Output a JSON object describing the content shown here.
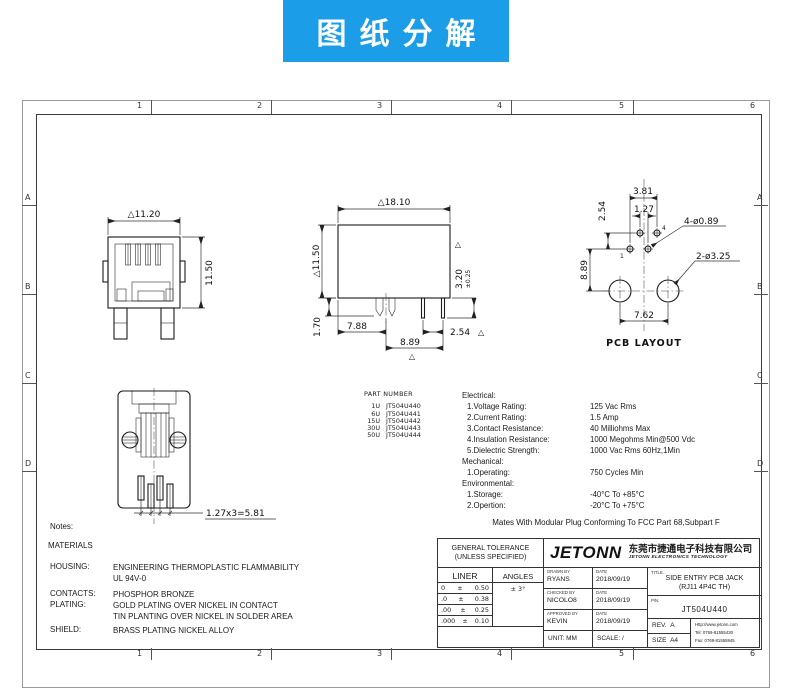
{
  "banner": {
    "title": "图纸分解",
    "bg": "#1b9de8"
  },
  "sheet": {
    "cols": [
      "1",
      "2",
      "3",
      "4",
      "5",
      "6"
    ],
    "rows": [
      "A",
      "B",
      "C",
      "D"
    ]
  },
  "views": {
    "front": {
      "dim_width": "△11.20",
      "dim_height": "11.50"
    },
    "side": {
      "dim_width": "△18.10",
      "dim_height": "△11.50",
      "dim_pin": "3.20",
      "dim_pin_tol": "±0.25",
      "tri": "△",
      "dim_latch": "1.70",
      "dim_a": "7.88",
      "dim_b": "2.54",
      "dim_c": "8.89"
    },
    "pcb": {
      "dim_top": "3.81",
      "dim_top2": "1.27",
      "dim_row": "2.54",
      "dim_col": "8.89",
      "dim_bottom": "7.62",
      "holes_small": "4-ø0.89",
      "holes_large": "2-ø3.25",
      "pin1": "1",
      "pin4": "4",
      "label": "PCB LAYOUT"
    },
    "bottom": {
      "dim_pitch": "1.27x3=5.81"
    }
  },
  "parts": {
    "header": "PART NUMBER",
    "rows": [
      {
        "qty": "1U",
        "pn": "JT504U440"
      },
      {
        "qty": "6U",
        "pn": "JT504U441"
      },
      {
        "qty": "15U",
        "pn": "JT504U442"
      },
      {
        "qty": "30U",
        "pn": "JT504U443"
      },
      {
        "qty": "50U",
        "pn": "JT504U444"
      }
    ]
  },
  "specs": {
    "groups": [
      {
        "title": "Electrical:",
        "items": [
          {
            "label": "1.Voltage Rating:",
            "value": "125 Vac Rms"
          },
          {
            "label": "2.Current Rating:",
            "value": "1.5 Amp"
          },
          {
            "label": "3.Contact Resistance:",
            "value": "40 Milliohms Max"
          },
          {
            "label": "4.Insulation Resistance:",
            "value": "1000 Megohms Min@500 Vdc"
          },
          {
            "label": "5.Dielectric Strength:",
            "value": "1000 Vac Rms 60Hz,1Min"
          }
        ]
      },
      {
        "title": "Mechanical:",
        "items": [
          {
            "label": "1.Operating:",
            "value": "750 Cycles Min"
          }
        ]
      },
      {
        "title": "Environmental:",
        "items": [
          {
            "label": "1.Storage:",
            "value": "-40°C To +85°C"
          },
          {
            "label": "2.Opertion:",
            "value": "-20°C To +75°C"
          }
        ]
      }
    ],
    "footnote": "Mates With Modular Plug Conforming To FCC Part 68,Subpart F"
  },
  "notes": {
    "title": "Notes:",
    "materials": "MATERIALS",
    "rows": [
      {
        "label": "HOUSING:",
        "line1": "ENGINEERING THERMOPLASTIC FLAMMABILITY",
        "line2": "UL 94V-0"
      },
      {
        "label": "CONTACTS:",
        "line1": "PHOSPHOR BRONZE",
        "line2": ""
      },
      {
        "label": "PLATING:",
        "line1": "GOLD PLATING OVER NICKEL IN CONTACT",
        "line2": "TIN PLANTING OVER NICKEL IN SOLDER AREA"
      },
      {
        "label": "SHIELD:",
        "line1": "BRASS PLATING NICKEL ALLOY",
        "line2": ""
      }
    ]
  },
  "tb": {
    "tol": {
      "h1": "GENERAL TOLERANCE",
      "h2": "(UNLESS SPECIFIED)",
      "c1": "LINER",
      "c2": "ANGLES",
      "angle": "± 3°",
      "rows": [
        {
          "d": "0",
          "pm": "±",
          "v": "0.50"
        },
        {
          "d": ".0",
          "pm": "±",
          "v": "0.38"
        },
        {
          "d": ".00",
          "pm": "±",
          "v": "0.25"
        },
        {
          "d": ".000",
          "pm": "±",
          "v": "0.10"
        }
      ]
    },
    "logo": "JETONN",
    "company_cn": "东莞市捷通电子科技有限公司",
    "company_en": "JETONN ELECTRONICS TECHNOLOGY",
    "sign": [
      {
        "label": "DRAWN BY",
        "name": "RYANS",
        "date_label": "DATE",
        "date": "2018/09/19"
      },
      {
        "label": "CHECKED BY",
        "name": "NICOLO8",
        "date_label": "DATE",
        "date": "2018/09/19"
      },
      {
        "label": "APPROVED BY",
        "name": "KEVIN",
        "date_label": "DATE",
        "date": "2018/09/19"
      }
    ],
    "unit_label": "UNIT:",
    "unit": "MM",
    "scale_label": "SCALE:",
    "scale": "/",
    "title_label": "TITLE.",
    "title1": "SIDE ENTRY PCB JACK",
    "title2": "(RJ11  4P4C TH)",
    "pn_label": "P/N.",
    "pn": "JT504U440",
    "rev_label": "REV.",
    "rev": "A",
    "size_label": "SIZE",
    "size": "A4",
    "web": "Http://www.jetonn.com",
    "tel": "Tel: 0769-81555430",
    "fax": "Fax: 0769-81555945"
  }
}
